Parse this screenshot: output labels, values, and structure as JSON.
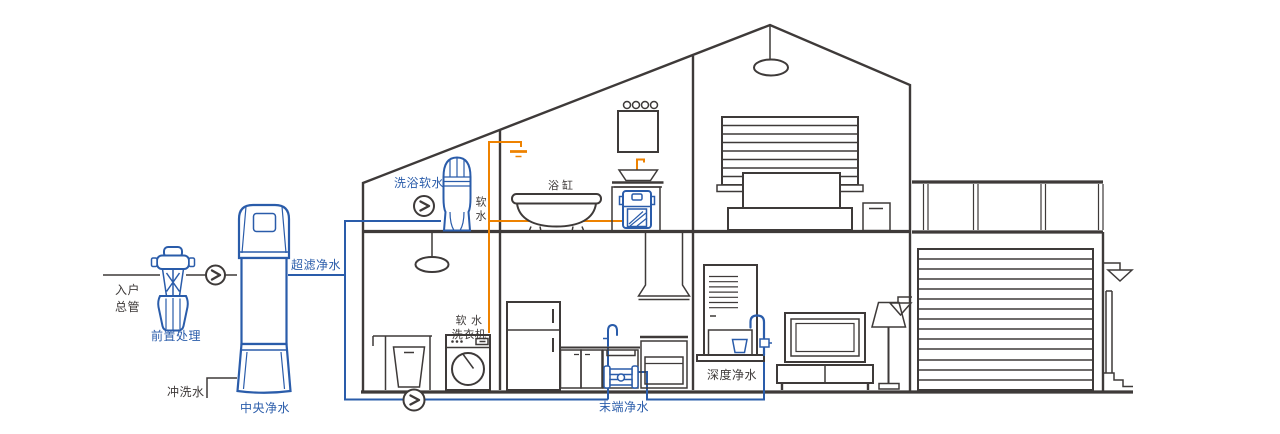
{
  "diagram": {
    "type": "whole-house-water-purification-cutaway",
    "colors": {
      "line": "#3e3a39",
      "blue": "#2a5caa",
      "orange": "#ee8200",
      "background": "#ffffff"
    },
    "labels": {
      "inlet_main": "入户\n总管",
      "pre_treatment": "前置处理",
      "central_purifier": "中央净水",
      "flush_water": "冲洗水",
      "ultrafiltration": "超滤净水",
      "shower_softener": "洗浴软水",
      "soft_water": "软水",
      "bathtub": "浴缸",
      "soft_water_washer": "软 水\n洗衣机",
      "terminal_purifier": "末端净水",
      "deep_purifier": "深度净水"
    },
    "icons": {
      "flow_arrow": "›"
    }
  }
}
